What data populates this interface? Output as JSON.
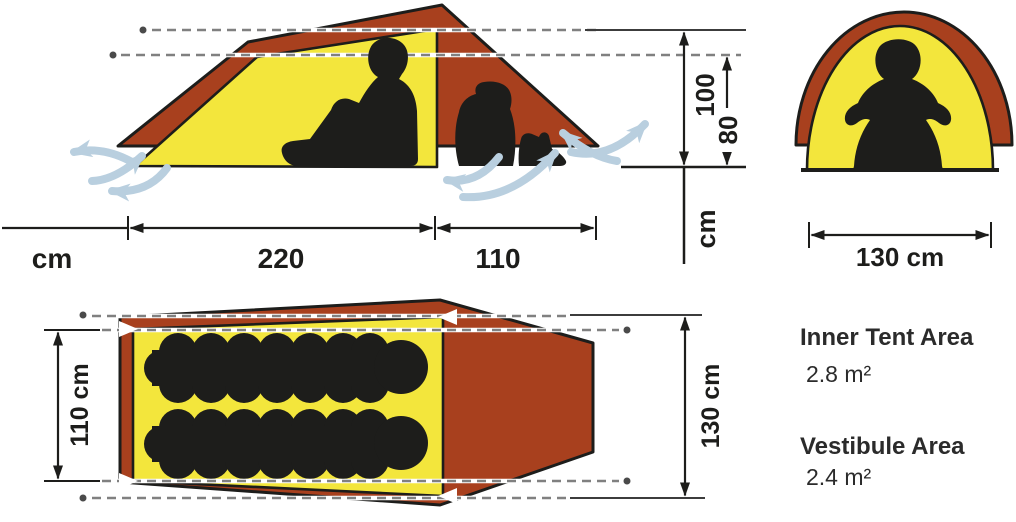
{
  "side_view": {
    "bottom_unit": "cm",
    "inner_length": "220",
    "vestibule_length": "110",
    "ridge_height": "100",
    "rear_height": "80",
    "height_unit": "cm"
  },
  "front_view": {
    "width": "130 cm"
  },
  "floor_plan": {
    "inner_width": "110 cm",
    "outer_width": "130 cm"
  },
  "areas": {
    "inner_label": "Inner Tent Area",
    "inner_value": "2.8 m²",
    "vestibule_label": "Vestibule Area",
    "vestibule_value": "2.4 m²"
  },
  "colors": {
    "fly_red": "#A8401E",
    "inner_yellow": "#F3E63C",
    "silhouette_black": "#1d1d1b",
    "airflow_blue": "#b9cfdf",
    "guide_gray": "#808080"
  },
  "icons": {
    "airflow": "curved-arrow",
    "corner_marker": "white-arrowhead"
  }
}
